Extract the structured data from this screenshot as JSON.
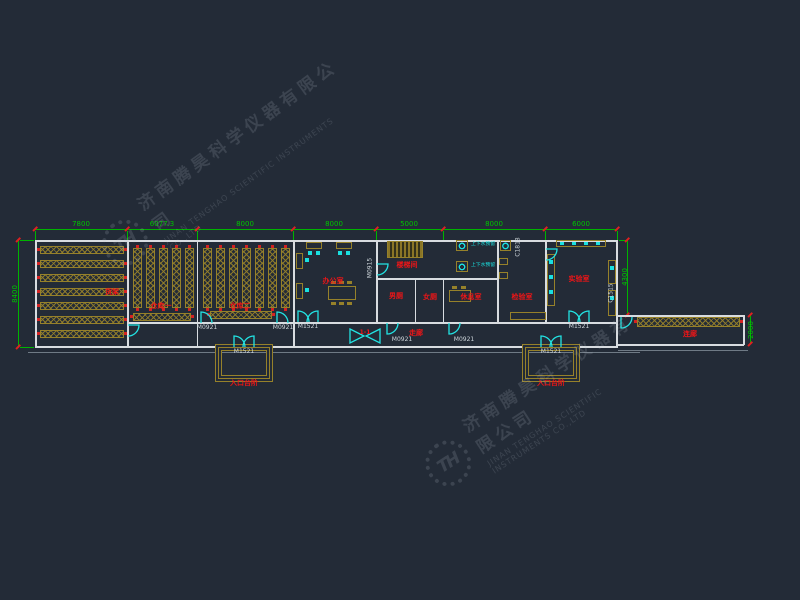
{
  "watermark": {
    "company_cn": "济南腾昊科学仪器有限公司",
    "company_en": "JINAN TENGHAO SCIENTIFIC INSTRUMENTS CO.,LTD",
    "logo_text": "TH"
  },
  "colors": {
    "background": "#232b37",
    "wall": "#d8dce0",
    "rack": "#96812a",
    "dimension_green": "#00b400",
    "label_red": "#ee1517",
    "door_cyan": "#22e3e3"
  },
  "dims": {
    "top": [
      "7800",
      "6077.3",
      "8000",
      "8000",
      "5000",
      "8000",
      "6000"
    ],
    "left": "8400",
    "right": "4300",
    "east": "2000"
  },
  "rooms": {
    "storage1": "仓库一",
    "storage2": "仓库二",
    "office": "办公室",
    "stair": "楼梯间",
    "wc_m": "男厕",
    "wc_f": "女厕",
    "rest": "休息室",
    "inspection": "检验室",
    "lab": "实验室",
    "corridor": "走廊",
    "east_corridor": "连廊"
  },
  "annotations": {
    "entrance1": "入口台阶",
    "entrance2": "入口台阶",
    "shelf_note": "货架",
    "section_mark": "1-1",
    "sink_note1": "上下水预留",
    "sink_note2": "上下水预留"
  },
  "door_labels": [
    "M1521",
    "M1521",
    "M1521",
    "M1521",
    "M0921",
    "M0921",
    "M0921",
    "M0921",
    "M0915"
  ],
  "window_labels": [
    "C1515",
    "C1818"
  ]
}
